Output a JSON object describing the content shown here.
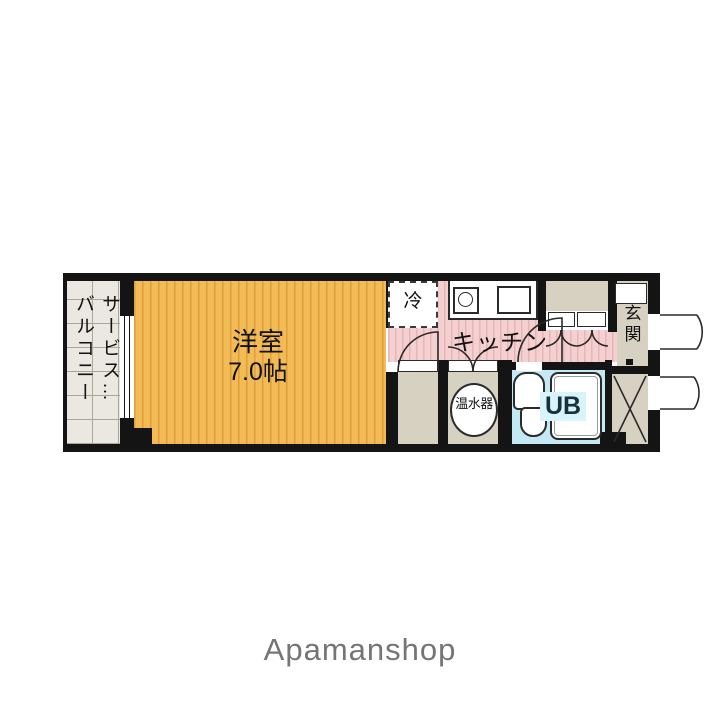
{
  "floorplan": {
    "balcony": {
      "label_right": "サービス…",
      "label_left": "バルコニー"
    },
    "western_room": {
      "name": "洋室",
      "size": "7.0帖"
    },
    "kitchen": {
      "name": "キッチン"
    },
    "refrigerator": {
      "name": "冷"
    },
    "entrance": {
      "name": "玄関"
    },
    "water_heater": {
      "name": "温水器"
    },
    "unit_bath": {
      "name": "UB"
    },
    "colors": {
      "wall": "#141414",
      "line": "#2a2a2a",
      "room-fill": "#f2bb55",
      "room-stripe": "#dd9f3c",
      "kitchen-fill": "#f4d0d0",
      "kitchen-stripe": "#e6b5b5",
      "beige": "#d6d1c1",
      "balcony-fill": "#eae8e0",
      "balcony-grid": "#a9a69a",
      "bath-fill": "#c3e9f4",
      "bath-label-bg": "#d9f3fa",
      "brand-gray": "#757575"
    }
  },
  "footer": {
    "brand": "Apamanshop"
  }
}
